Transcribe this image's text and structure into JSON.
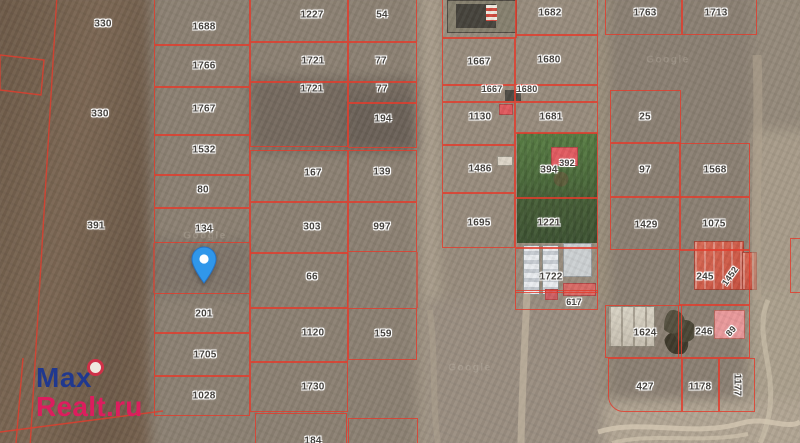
{
  "watermark": {
    "line1": "Max",
    "line2": "Realt.ru",
    "max_color": "#20388f",
    "realt_color": "#dc1d5e",
    "logo_ring": "#cf3148",
    "logo_fill": "#efe9df"
  },
  "map": {
    "parcel_border_color": "#e33c2c",
    "label_color": "#45423e",
    "pin": {
      "x": 204,
      "tip_y": 283,
      "color": "#3097ea",
      "stroke": "#2672c4"
    },
    "ghost_watermarks": [
      {
        "t": "Google",
        "x": 205,
        "y": 236
      },
      {
        "t": "Google",
        "x": 668,
        "y": 60
      },
      {
        "t": "Google",
        "x": 470,
        "y": 368
      }
    ],
    "parcels": [
      {
        "l": "1688",
        "x": 154,
        "y": -12,
        "w": 96,
        "h": 57,
        "lx": 204,
        "ly": 27
      },
      {
        "l": "1766",
        "x": 154,
        "y": 45,
        "w": 96,
        "h": 42,
        "lx": 204,
        "ly": 66
      },
      {
        "l": "1767",
        "x": 154,
        "y": 87,
        "w": 96,
        "h": 48,
        "lx": 204,
        "ly": 109
      },
      {
        "l": "1532",
        "x": 154,
        "y": 135,
        "w": 96,
        "h": 40,
        "lx": 204,
        "ly": 150
      },
      {
        "l": "80",
        "x": 154,
        "y": 175,
        "w": 96,
        "h": 33,
        "lx": 203,
        "ly": 190
      },
      {
        "l": "134",
        "x": 154,
        "y": 208,
        "w": 96,
        "h": 35,
        "lx": 204,
        "ly": 229
      },
      {
        "l": "201",
        "x": 154,
        "y": 293,
        "w": 96,
        "h": 40,
        "lx": 204,
        "ly": 314
      },
      {
        "l": "1705",
        "x": 154,
        "y": 333,
        "w": 96,
        "h": 43,
        "lx": 205,
        "ly": 355
      },
      {
        "l": "1028",
        "x": 154,
        "y": 376,
        "w": 96,
        "h": 40,
        "lx": 204,
        "ly": 396
      },
      {
        "l": "1227",
        "x": 250,
        "y": -10,
        "w": 98,
        "h": 52,
        "lx": 312,
        "ly": 15
      },
      {
        "l": "1721",
        "x": 250,
        "y": 42,
        "w": 98,
        "h": 40,
        "lx": 313,
        "ly": 61
      },
      {
        "l": "1721",
        "x": 250,
        "y": 82,
        "w": 98,
        "h": 65,
        "lx": 312,
        "ly": 89
      },
      {
        "l": "167",
        "x": 250,
        "y": 150,
        "w": 98,
        "h": 52,
        "lx": 313,
        "ly": 173
      },
      {
        "l": "303",
        "x": 250,
        "y": 202,
        "w": 98,
        "h": 51,
        "lx": 312,
        "ly": 227
      },
      {
        "l": "66",
        "x": 250,
        "y": 253,
        "w": 98,
        "h": 55,
        "lx": 312,
        "ly": 277
      },
      {
        "l": "1120",
        "x": 250,
        "y": 308,
        "w": 98,
        "h": 54,
        "lx": 313,
        "ly": 333
      },
      {
        "l": "1730",
        "x": 250,
        "y": 362,
        "w": 98,
        "h": 50,
        "lx": 313,
        "ly": 387
      },
      {
        "l": "",
        "x": 255,
        "y": 413,
        "w": 92,
        "h": 35
      },
      {
        "l": "54",
        "x": 348,
        "y": -10,
        "w": 69,
        "h": 52,
        "lx": 382,
        "ly": 15
      },
      {
        "l": "77",
        "x": 348,
        "y": 42,
        "w": 69,
        "h": 40,
        "lx": 381,
        "ly": 61
      },
      {
        "l": "77",
        "x": 348,
        "y": 82,
        "w": 69,
        "h": 21,
        "lx": 382,
        "ly": 89
      },
      {
        "l": "194",
        "x": 348,
        "y": 103,
        "w": 69,
        "h": 45,
        "lx": 383,
        "ly": 119
      },
      {
        "l": "139",
        "x": 348,
        "y": 150,
        "w": 69,
        "h": 52,
        "lx": 382,
        "ly": 172
      },
      {
        "l": "997",
        "x": 348,
        "y": 202,
        "w": 69,
        "h": 50,
        "lx": 382,
        "ly": 227
      },
      {
        "l": "159",
        "x": 348,
        "y": 308,
        "w": 69,
        "h": 52,
        "lx": 383,
        "ly": 334
      },
      {
        "l": "",
        "x": 348,
        "y": 418,
        "w": 70,
        "h": 30
      },
      {
        "l": "",
        "x": 442,
        "y": -20,
        "w": 75,
        "h": 58
      },
      {
        "l": "1667",
        "x": 442,
        "y": 38,
        "w": 73,
        "h": 47,
        "lx": 479,
        "ly": 62
      },
      {
        "l": "1667",
        "x": 442,
        "y": 85,
        "w": 73,
        "h": 17,
        "lx": 492,
        "ly": 89,
        "fs": 9
      },
      {
        "l": "1130",
        "x": 442,
        "y": 102,
        "w": 73,
        "h": 43,
        "lx": 480,
        "ly": 117
      },
      {
        "l": "1486",
        "x": 442,
        "y": 145,
        "w": 73,
        "h": 48,
        "lx": 480,
        "ly": 169
      },
      {
        "l": "1695",
        "x": 442,
        "y": 193,
        "w": 73,
        "h": 55,
        "lx": 479,
        "ly": 223
      },
      {
        "l": "1682",
        "x": 515,
        "y": -20,
        "w": 83,
        "h": 55,
        "lx": 550,
        "ly": 13
      },
      {
        "l": "1680",
        "x": 515,
        "y": 35,
        "w": 83,
        "h": 50,
        "lx": 549,
        "ly": 60
      },
      {
        "l": "1680",
        "x": 515,
        "y": 85,
        "w": 83,
        "h": 17,
        "lx": 527,
        "ly": 89,
        "fs": 9
      },
      {
        "l": "1681",
        "x": 515,
        "y": 102,
        "w": 83,
        "h": 31,
        "lx": 551,
        "ly": 117
      },
      {
        "l": "394",
        "x": 515,
        "y": 133,
        "w": 83,
        "h": 65,
        "lx": 549,
        "ly": 170
      },
      {
        "l": "1221",
        "x": 515,
        "y": 198,
        "w": 83,
        "h": 50,
        "lx": 549,
        "ly": 223
      },
      {
        "l": "1722",
        "x": 515,
        "y": 248,
        "w": 83,
        "h": 45,
        "lx": 551,
        "ly": 277
      },
      {
        "l": "617",
        "x": 515,
        "y": 290,
        "w": 83,
        "h": 20,
        "lx": 574,
        "ly": 302,
        "fs": 9
      },
      {
        "l": "1763",
        "x": 605,
        "y": -15,
        "w": 77,
        "h": 50,
        "lx": 645,
        "ly": 13
      },
      {
        "l": "1713",
        "x": 682,
        "y": -15,
        "w": 75,
        "h": 50,
        "lx": 716,
        "ly": 13
      },
      {
        "l": "25",
        "x": 610,
        "y": 90,
        "w": 71,
        "h": 53,
        "lx": 645,
        "ly": 117
      },
      {
        "l": "97",
        "x": 610,
        "y": 143,
        "w": 71,
        "h": 54,
        "lx": 645,
        "ly": 170
      },
      {
        "l": "1429",
        "x": 610,
        "y": 197,
        "w": 71,
        "h": 53,
        "lx": 646,
        "ly": 225
      },
      {
        "l": "1568",
        "x": 679,
        "y": 143,
        "w": 71,
        "h": 54,
        "lx": 715,
        "ly": 170
      },
      {
        "l": "1075",
        "x": 679,
        "y": 197,
        "w": 71,
        "h": 53,
        "lx": 714,
        "ly": 224
      },
      {
        "l": "245",
        "x": 679,
        "y": 250,
        "w": 71,
        "h": 55,
        "lx": 705,
        "ly": 277
      },
      {
        "l": "1624",
        "x": 605,
        "y": 305,
        "w": 77,
        "h": 53,
        "lx": 645,
        "ly": 333
      },
      {
        "l": "246",
        "x": 678,
        "y": 305,
        "w": 72,
        "h": 53,
        "lx": 704,
        "ly": 332
      },
      {
        "l": "427",
        "x": 608,
        "y": 358,
        "w": 74,
        "h": 54,
        "lx": 645,
        "ly": 387,
        "r": "bl"
      },
      {
        "l": "1178",
        "x": 682,
        "y": 358,
        "w": 37,
        "h": 54,
        "lx": 700,
        "ly": 387
      },
      {
        "l": "1177",
        "x": 719,
        "y": 358,
        "w": 36,
        "h": 54,
        "lx": 737,
        "ly": 385,
        "lr": 90
      },
      {
        "l": "",
        "x": 790,
        "y": 238,
        "w": 40,
        "h": 55
      }
    ],
    "standalone_labels": [
      {
        "t": "330",
        "x": 103,
        "y": 24
      },
      {
        "t": "330",
        "x": 100,
        "y": 114
      },
      {
        "t": "391",
        "x": 96,
        "y": 226
      },
      {
        "t": "184",
        "x": 313,
        "y": 441
      },
      {
        "t": "392",
        "x": 567,
        "y": 163,
        "fs": 9
      },
      {
        "t": "1452",
        "x": 730,
        "y": 276,
        "r": -55,
        "fs": 9
      },
      {
        "t": "89",
        "x": 731,
        "y": 331,
        "r": -48,
        "fs": 9
      }
    ],
    "buildings": [
      {
        "n": "green-field",
        "x": 517,
        "y": 133,
        "w": 80,
        "h": 110,
        "c": "green"
      },
      {
        "n": "warehouse-building",
        "x": 447,
        "y": 0,
        "w": 70,
        "h": 33,
        "f": "#87816f",
        "b": "#4f4a42"
      },
      {
        "n": "warehouse-dark-roof",
        "x": 456,
        "y": 4,
        "w": 40,
        "h": 24,
        "f": "#46433c"
      },
      {
        "n": "warehouse-red-white-marks",
        "x": 486,
        "y": 5,
        "w": 11,
        "h": 16,
        "c": "striped"
      },
      {
        "n": "dark-shed",
        "x": 505,
        "y": 90,
        "w": 16,
        "h": 11,
        "f": "#4d4a43"
      },
      {
        "n": "red-building-1130",
        "x": 499,
        "y": 104,
        "w": 14,
        "h": 11,
        "f": "#e15a5e",
        "b": "#b24747"
      },
      {
        "n": "red-building-392",
        "x": 551,
        "y": 147,
        "w": 27,
        "h": 19,
        "f": "#e25b60",
        "b": "#b24747"
      },
      {
        "n": "utility-post",
        "x": 497,
        "y": 156,
        "w": 16,
        "h": 10,
        "f": "#ddd6c8",
        "b": "#9a9487"
      },
      {
        "n": "greenhouse-strip-1",
        "x": 523,
        "y": 245,
        "w": 17,
        "h": 50,
        "c": "glass"
      },
      {
        "n": "greenhouse-strip-2",
        "x": 542,
        "y": 245,
        "w": 17,
        "h": 50,
        "c": "glass"
      },
      {
        "n": "white-building",
        "x": 563,
        "y": 243,
        "w": 29,
        "h": 34,
        "f": "#ccd0d2",
        "b": "#979b9d"
      },
      {
        "n": "red-building-617a",
        "x": 563,
        "y": 283,
        "w": 33,
        "h": 13,
        "f": "#d96b66",
        "b": "#b24747"
      },
      {
        "n": "red-building-617b",
        "x": 545,
        "y": 289,
        "w": 13,
        "h": 11,
        "f": "#cf5f63",
        "b": "#b24747"
      },
      {
        "n": "red-roof-house-1452",
        "x": 694,
        "y": 241,
        "w": 50,
        "h": 49,
        "c": "red-roof"
      },
      {
        "n": "red-roof-wing",
        "x": 742,
        "y": 252,
        "w": 15,
        "h": 38,
        "c": "red-roof"
      },
      {
        "n": "pink-building-89",
        "x": 714,
        "y": 310,
        "w": 31,
        "h": 29,
        "f": "#e9999b",
        "b": "#b9695f"
      },
      {
        "n": "white-roof-building-1624",
        "x": 608,
        "y": 306,
        "w": 47,
        "h": 41,
        "c": "panel"
      },
      {
        "n": "trees-cluster",
        "x": 664,
        "y": 308,
        "w": 30,
        "h": 46,
        "c": "trees"
      }
    ],
    "boundary_paths": [
      "M57,-5 L30,448",
      "M0,55 L44,60 L41,95 L0,90 Z",
      "M0,432 L163,411",
      "M23,358 L16,443",
      "M154,243 L154,293",
      "M250,243 L250,293",
      "M417,252 L417,308",
      "M348,252 L348,308"
    ],
    "track_paths": [
      {
        "d": "M527,293 C525,340 522,390 521,443",
        "s": "#c9bca6",
        "w": 7,
        "o": 0.6
      },
      {
        "d": "M757,55 C760,130 754,210 757,300",
        "s": "#b3a691",
        "w": 9,
        "o": 0.5
      },
      {
        "d": "M598,432 C640,418 692,438 742,423 C766,416 786,430 800,422",
        "s": "#d8ccb6",
        "w": 5,
        "o": 0.7
      },
      {
        "d": "M612,443 C652,432 700,444 748,434",
        "s": "#d8ccb6",
        "w": 4,
        "o": 0.55
      },
      {
        "d": "M768,300 C750,342 788,382 760,443",
        "s": "#d2c6b0",
        "w": 5,
        "o": 0.55
      },
      {
        "d": "M430,310 C436,360 432,405 438,443",
        "s": "#b4a894",
        "w": 6,
        "o": 0.4
      }
    ]
  }
}
